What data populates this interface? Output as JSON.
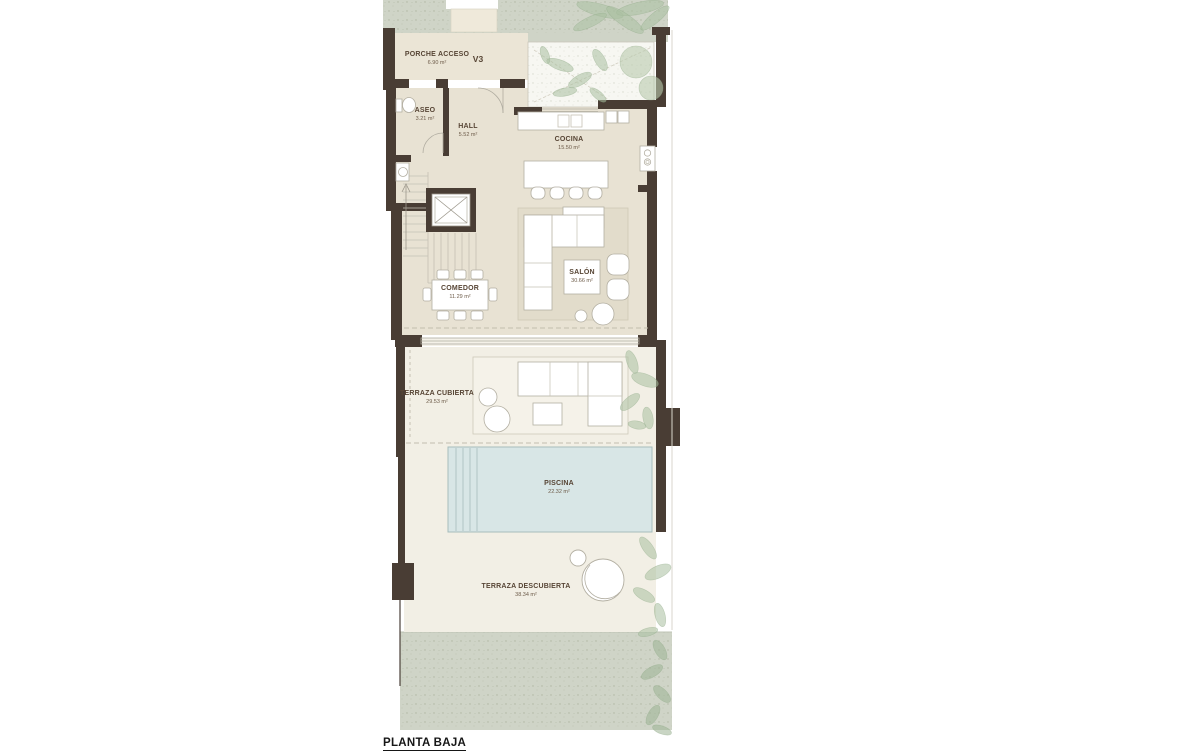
{
  "plan": {
    "title": "PLANTA BAJA",
    "scale": "e 1:100",
    "unit": "V3"
  },
  "rooms": {
    "porche": {
      "name": "PORCHE ACCESO",
      "area": "6.90 m²"
    },
    "aseo": {
      "name": "ASEO",
      "area": "3.21 m²"
    },
    "hall": {
      "name": "HALL",
      "area": "5.52 m²"
    },
    "cocina": {
      "name": "COCINA",
      "area": "15.50 m²"
    },
    "comedor": {
      "name": "COMEDOR",
      "area": "11.29 m²"
    },
    "salon": {
      "name": "SALÓN",
      "area": "30.66 m²"
    },
    "terraza_cubierta": {
      "name": "TERRAZA CUBIERTA",
      "area": "29.53 m²"
    },
    "piscina": {
      "name": "PISCINA",
      "area": "22.32 m²"
    },
    "terraza_descubierta": {
      "name": "TERRAZA DESCUBIERTA",
      "area": "38.34 m²"
    }
  },
  "colors": {
    "wall": "#493d34",
    "floor_interior": "#e8e2d3",
    "floor_porche": "#ebe5d6",
    "floor_terrace": "#f2efe5",
    "rug": "#e2dccb",
    "garden": "#cfd4c7",
    "pool": "#d8e6e6",
    "pool_edge": "#a7bcbc",
    "plant": "#a9bfa0",
    "furniture_stroke": "#b3afa2",
    "label_text": "#574535"
  }
}
